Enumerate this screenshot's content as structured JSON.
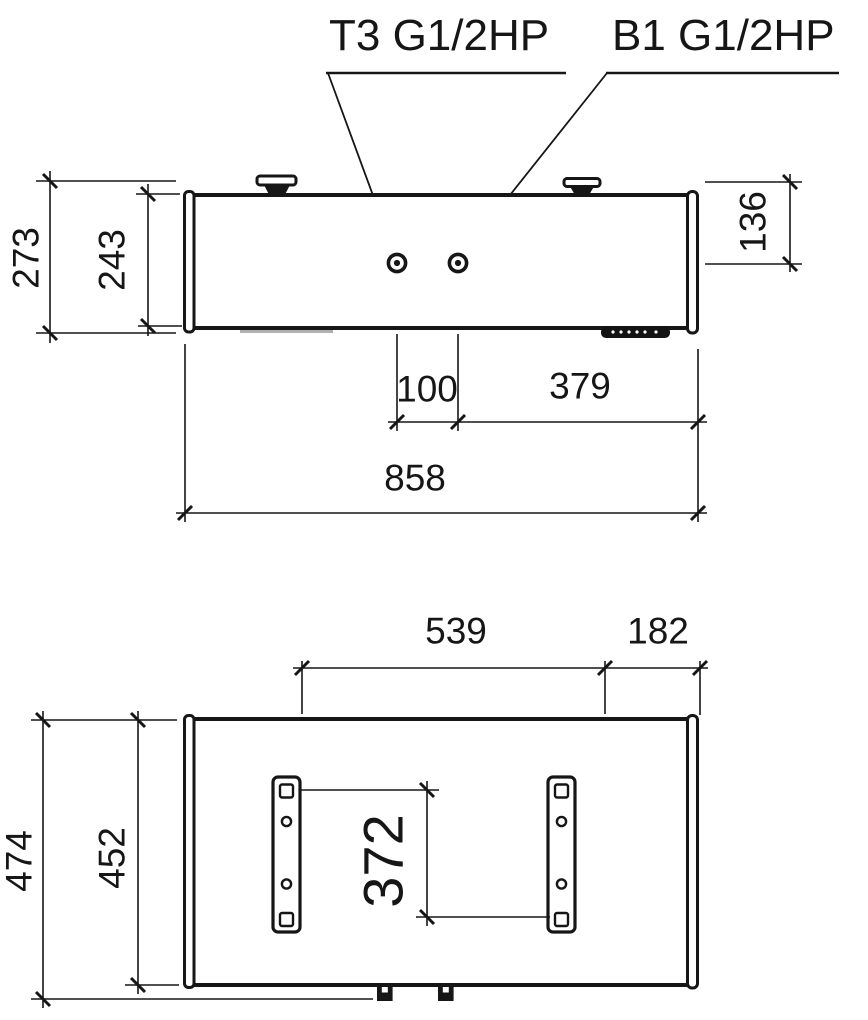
{
  "top_view": {
    "labels": {
      "t3": "T3 G1/2HP",
      "b1": "B1 G1/2HP"
    },
    "dims": {
      "overall_height": "273",
      "body_height": "243",
      "ports_from_top": "136",
      "port_spacing": "100",
      "port_to_end": "379",
      "overall_length": "858"
    }
  },
  "bottom_view": {
    "dims": {
      "bracket_span": "539",
      "bracket_to_end": "182",
      "hole_span": "372",
      "overall_width": "474",
      "body_width": "452"
    }
  },
  "colors": {
    "ink": "#161616",
    "background": "#ffffff"
  }
}
